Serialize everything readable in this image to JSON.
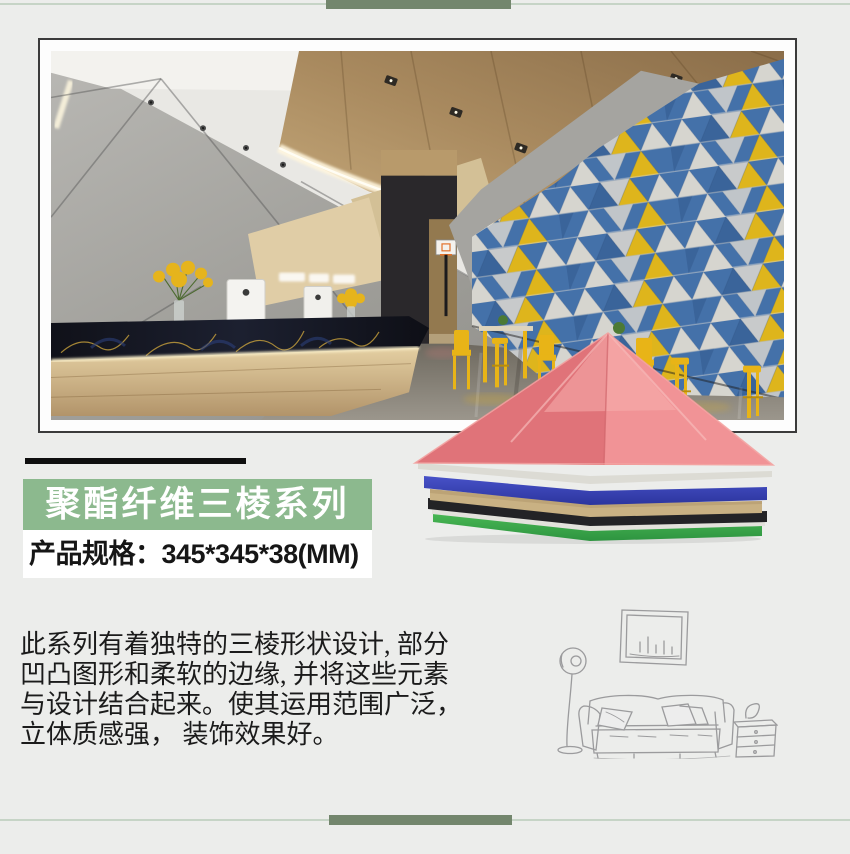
{
  "css_colors": {
    "page_bg": "#ecedeb",
    "top_line": "#c6d4c6",
    "accent_bar": "#73866d",
    "band_green": "#8cb98e"
  },
  "title_band": {
    "label": "聚酯纤维三棱系列",
    "background": "#8cb98e",
    "text_color": "#ffffff"
  },
  "spec_band": {
    "label": "产品规格：345*345*38(MM)",
    "background": "#ffffff",
    "text_color": "#161616"
  },
  "description": {
    "text": "此系列有着独特的三棱形状设计, 部分\n凹凸图形和柔软的边缘, 并将这些元素\n与设计结合起来。使其运用范围广泛，\n立体质感强， 装饰效果好。"
  },
  "product_stack": {
    "layers": [
      {
        "name": "red-pyramid-panel",
        "color": "#e4696d"
      },
      {
        "name": "white-felt-sheet",
        "color": "#dcdbd4"
      },
      {
        "name": "blue-felt-sheet",
        "color": "#3c48bd"
      },
      {
        "name": "tan-felt-sheet",
        "color": "#c9b183"
      },
      {
        "name": "black-felt-sheet",
        "color": "#232326"
      },
      {
        "name": "white-felt-sheet-2",
        "color": "#e3e2dc"
      },
      {
        "name": "green-felt-sheet",
        "color": "#3fae4a"
      }
    ]
  },
  "photo": {
    "wall_triangle_colors": {
      "blue": "#4a7bb7",
      "white": "#e9e7e0",
      "yellow": "#f1c51e",
      "dark_blue": "#3f6ca6"
    },
    "wood_ceiling": "#a98a5f",
    "floor": "#847f75",
    "chair_yellow": "#e8b417"
  }
}
